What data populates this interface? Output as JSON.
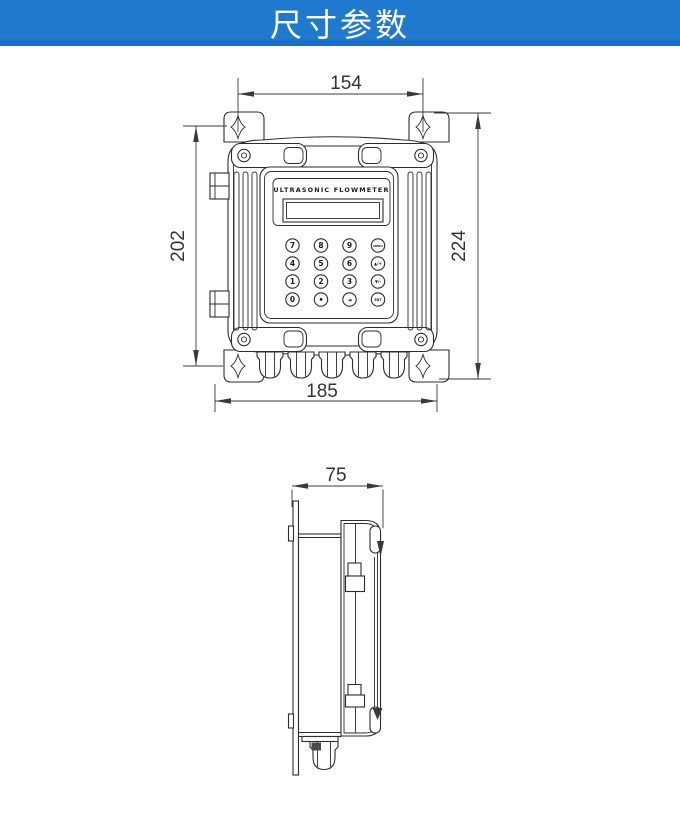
{
  "header": {
    "title": "尺寸参数",
    "background_color": "#1f7acf",
    "band_color": "#1b70c3",
    "text_color": "#ffffff"
  },
  "drawing": {
    "line_color": "#2d2d2d",
    "front_view": {
      "device_label": "ULTRASONIC FLOWMETER",
      "dims": {
        "mount_hole_spacing": "154",
        "mount_hole_height": "202",
        "overall_height": "224",
        "body_width": "185"
      },
      "keypad": {
        "rows": [
          [
            "7",
            "8",
            "9",
            "MENU"
          ],
          [
            "4",
            "5",
            "6",
            "▲/+"
          ],
          [
            "1",
            "2",
            "3",
            "▼/-"
          ],
          [
            "0",
            "•",
            "◄",
            "ENT"
          ]
        ]
      }
    },
    "side_view": {
      "dims": {
        "depth": "75"
      }
    }
  }
}
